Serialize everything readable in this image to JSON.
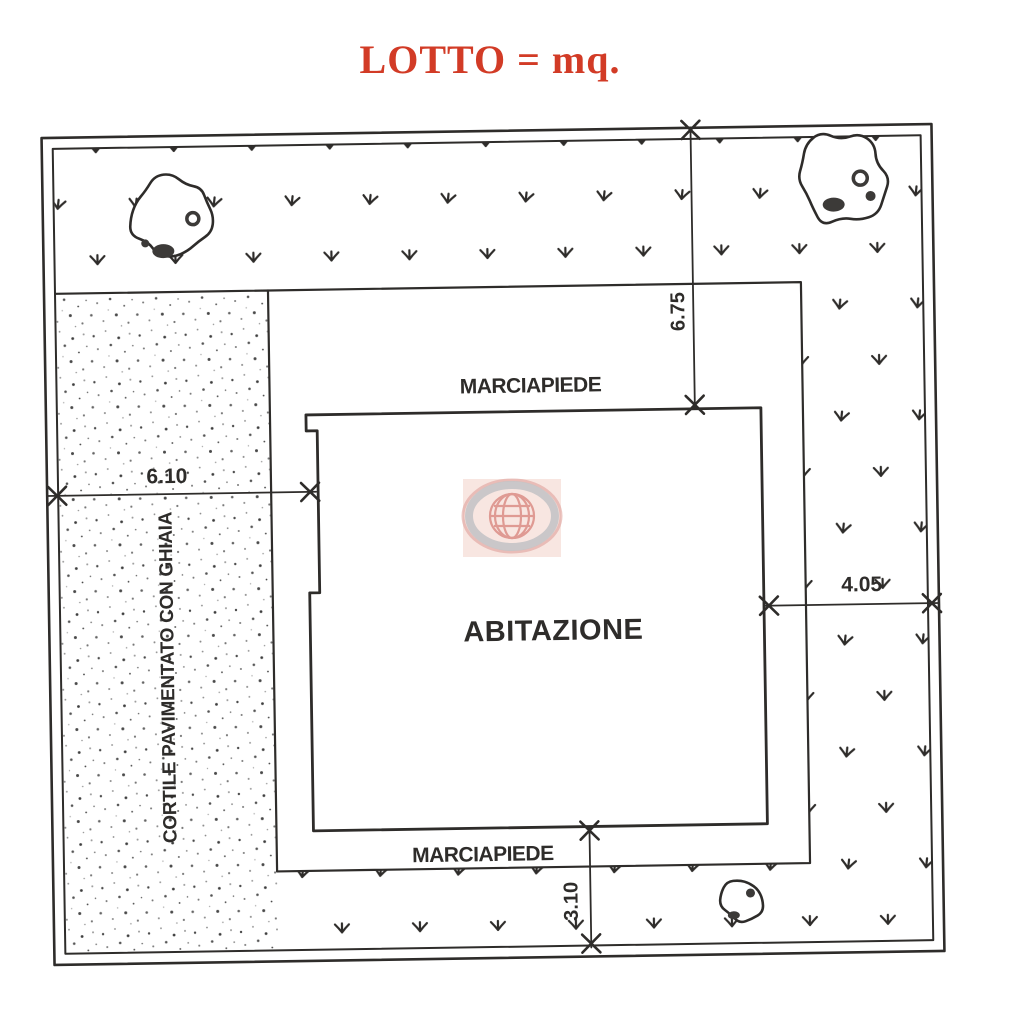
{
  "title": "LOTTO = mq.",
  "colors": {
    "title_red": "#d23b26",
    "ink": "#2e2c2a",
    "paper": "#ffffff",
    "watermark_red": "#c0392b",
    "watermark_gray": "#8f8f94",
    "watermark_pink": "#e2937e"
  },
  "plan": {
    "labels": {
      "sidewalk_top": "MARCIAPIEDE",
      "sidewalk_bottom": "MARCIAPIEDE",
      "house": "ABITAZIONE",
      "courtyard": "CORTILE PAVIMENTATO CON GHIAIA"
    },
    "dimensions": {
      "top_right": "6.75",
      "left": "6.10",
      "right": "4.05",
      "bottom": "3.10"
    },
    "icons": {
      "grass": "grass-tuft-icon",
      "gravel": "stipple-dots",
      "tree": "tree-canopy-scribble-icon",
      "dimension_tick": "x-tick-icon",
      "watermark": "globe-logo-icon"
    }
  }
}
